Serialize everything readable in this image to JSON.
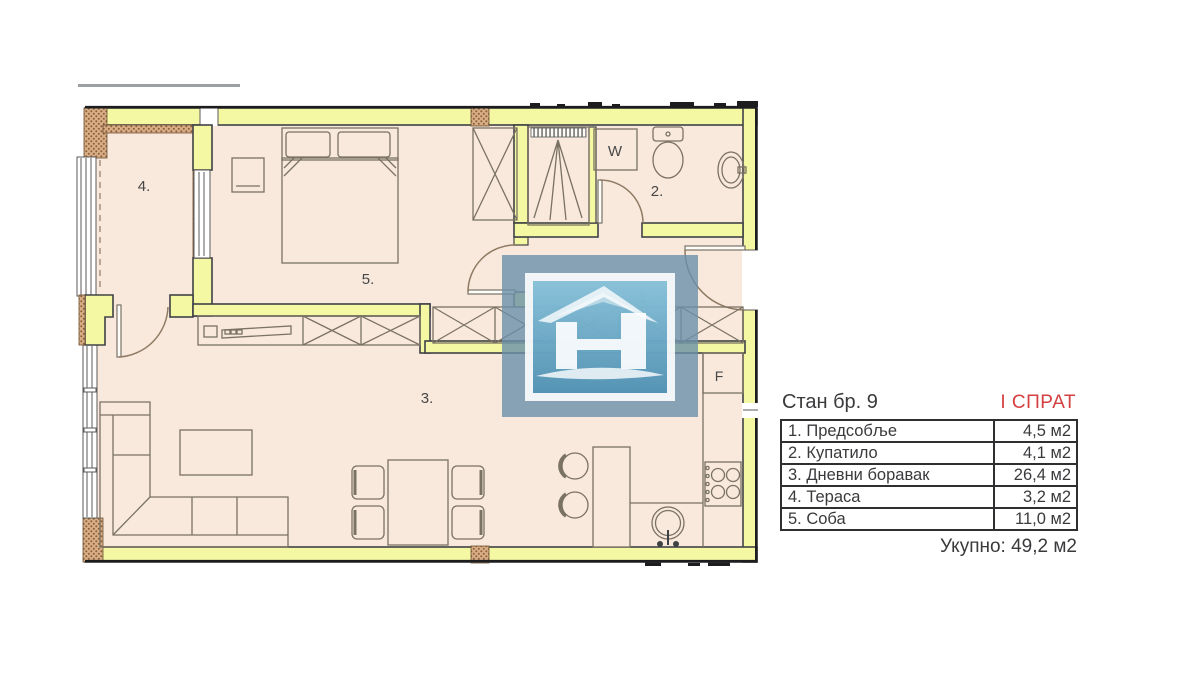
{
  "plan": {
    "room_labels": {
      "hallway": "1.",
      "bathroom": "2.",
      "living_room": "3.",
      "terrace": "4.",
      "bedroom": "5."
    },
    "appliance_labels": {
      "washing_machine": "W",
      "fridge": "F"
    }
  },
  "panel": {
    "title": "Стан бр. 9",
    "floor": "I СПРАТ",
    "rows": [
      {
        "label": "1. Предсобље",
        "area": "4,5 м2"
      },
      {
        "label": "2. Купатило",
        "area": "4,1 м2"
      },
      {
        "label": "3. Дневни боравак",
        "area": "26,4 м2"
      },
      {
        "label": "4. Тераса",
        "area": "3,2 м2"
      },
      {
        "label": "5. Соба",
        "area": "11,0 м2"
      }
    ],
    "total": "Укупно: 49,2 м2"
  },
  "colors": {
    "wall": "#f5f8a3",
    "floor": "#f9e9dc",
    "accent_red": "#d43f40",
    "logo_blue": "#5e9cbd",
    "line": "#3f4245"
  }
}
